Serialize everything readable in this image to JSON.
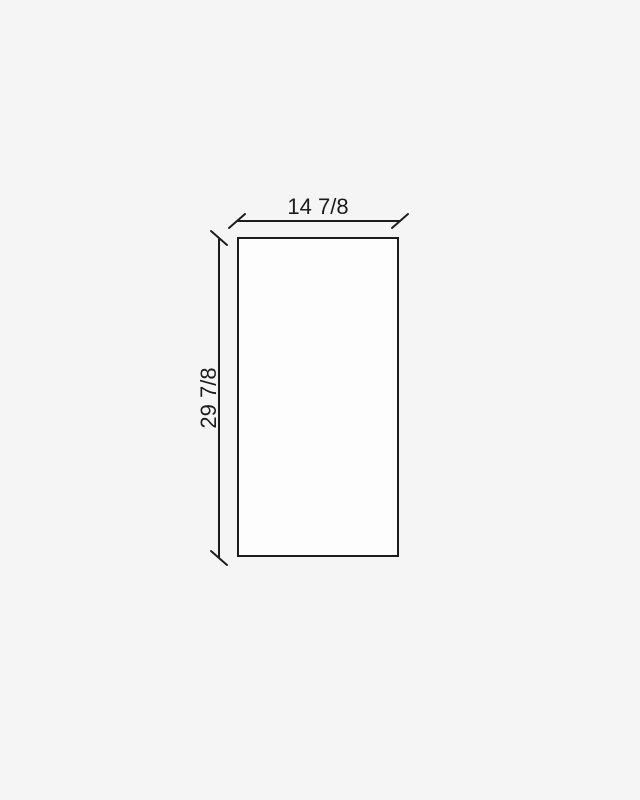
{
  "diagram": {
    "type": "panel-dimension-drawing",
    "shape": "rectangle",
    "width_label": "14 7/8",
    "height_label": "29 7/8"
  },
  "colors": {
    "background": "#f5f5f5",
    "panel_fill": "#fdfdfd",
    "line": "#1c1c1c",
    "text": "#1c1c1c"
  }
}
